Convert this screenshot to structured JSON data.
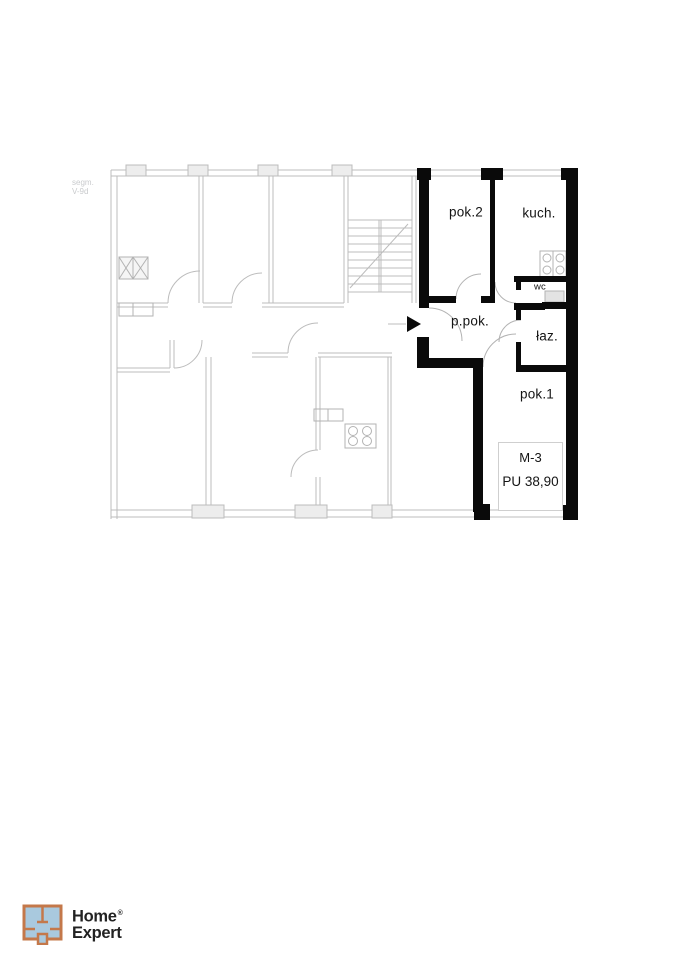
{
  "plan": {
    "floor_note": {
      "line1": "segm.",
      "line2": "V-9d"
    },
    "rooms": {
      "pok2": "pok.2",
      "kuch": "kuch.",
      "wc": "wc",
      "ppok": "p.pok.",
      "laz": "łaz.",
      "pok1": "pok.1"
    },
    "unit_card": {
      "unit": "M-3",
      "area": "PU 38,90"
    }
  },
  "logo": {
    "word1": "Home",
    "word2": "Expert",
    "registered": "®"
  },
  "colors": {
    "wall": "#0a0a0a",
    "line": "#bcbcbc",
    "pier_fill": "#ededed",
    "label": "#141414",
    "faint": "#c9cbcd",
    "logo_orange": "#c4784a",
    "logo_blue": "#a9c9de",
    "logo_text": "#222222"
  }
}
